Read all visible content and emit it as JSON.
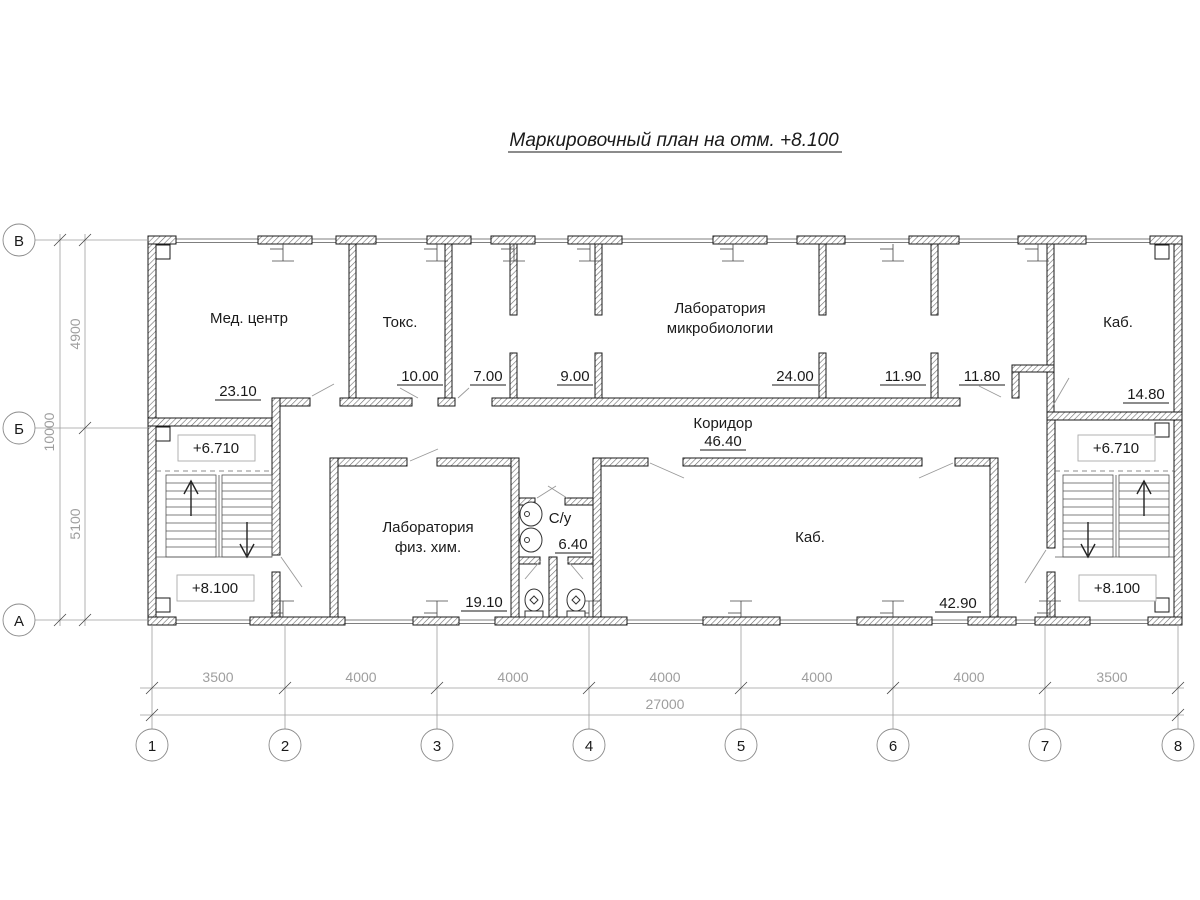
{
  "title": "Маркировочный план на отм. +8.100",
  "rooms": {
    "med_center": {
      "label": "Мед. центр",
      "area": "23.10"
    },
    "toks": {
      "label": "Токс.",
      "area": "10.00"
    },
    "room7": {
      "area": "7.00"
    },
    "room9": {
      "area": "9.00"
    },
    "micro_lab": {
      "label1": "Лаборатория",
      "label2": "микробиологии",
      "area": "24.00"
    },
    "room1190": {
      "area": "11.90"
    },
    "room1180": {
      "area": "11.80"
    },
    "kab_top": {
      "label": "Каб.",
      "area": "14.80"
    },
    "corridor": {
      "label": "Коридор",
      "area": "46.40"
    },
    "phys_lab": {
      "label1": "Лаборатория",
      "label2": "физ. хим.",
      "area": "19.10"
    },
    "sanitary": {
      "label": "С/у",
      "area": "6.40"
    },
    "kab_main": {
      "label": "Каб.",
      "area": "42.90"
    }
  },
  "elevations": {
    "upper_left": "+6.710",
    "lower_left": "+8.100",
    "upper_right": "+6.710",
    "lower_right": "+8.100"
  },
  "axes": {
    "columns": [
      "1",
      "2",
      "3",
      "4",
      "5",
      "6",
      "7",
      "8"
    ],
    "rows": [
      "В",
      "Б",
      "А"
    ]
  },
  "dimensions": {
    "bottom_segments": [
      "3500",
      "4000",
      "4000",
      "4000",
      "4000",
      "4000",
      "3500"
    ],
    "bottom_total": "27000",
    "left_segments": [
      "4900",
      "5100"
    ],
    "left_total": "10000"
  }
}
